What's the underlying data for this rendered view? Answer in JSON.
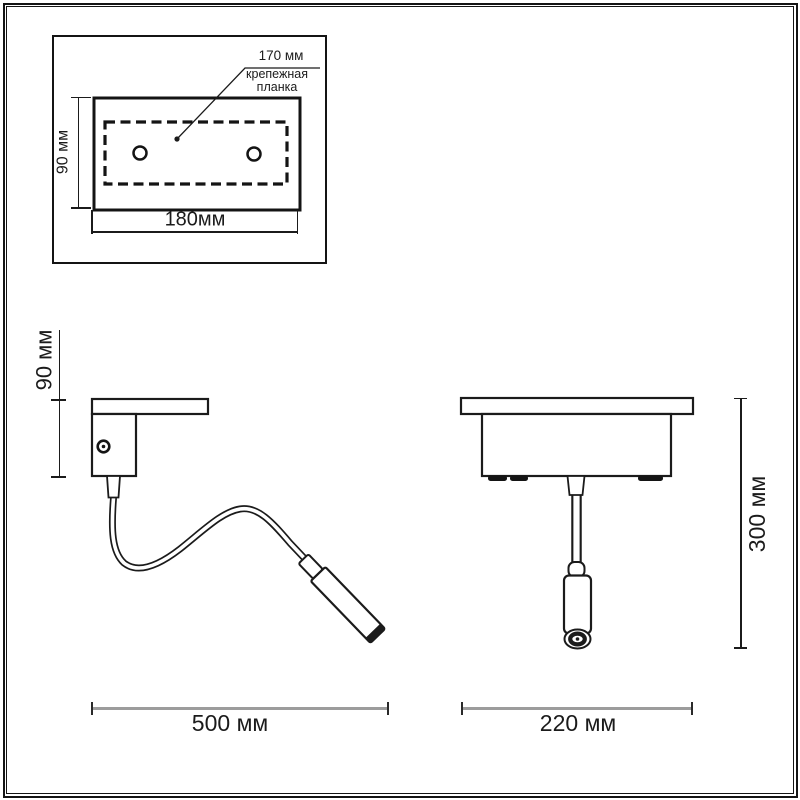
{
  "palette": {
    "line_color": "#1b1b1b",
    "dimension_gray": "#9c9c9c",
    "background": "#ffffff"
  },
  "top_view": {
    "hole_distance_label": "170 мм",
    "callout_line1": "крепежная",
    "callout_line2": "планка",
    "height_label": "90 мм",
    "width_label": "180мм"
  },
  "side_view": {
    "height_label": "90 мм",
    "width_label": "500 мм"
  },
  "front_view": {
    "height_label": "300 мм",
    "width_label": "220 мм"
  }
}
